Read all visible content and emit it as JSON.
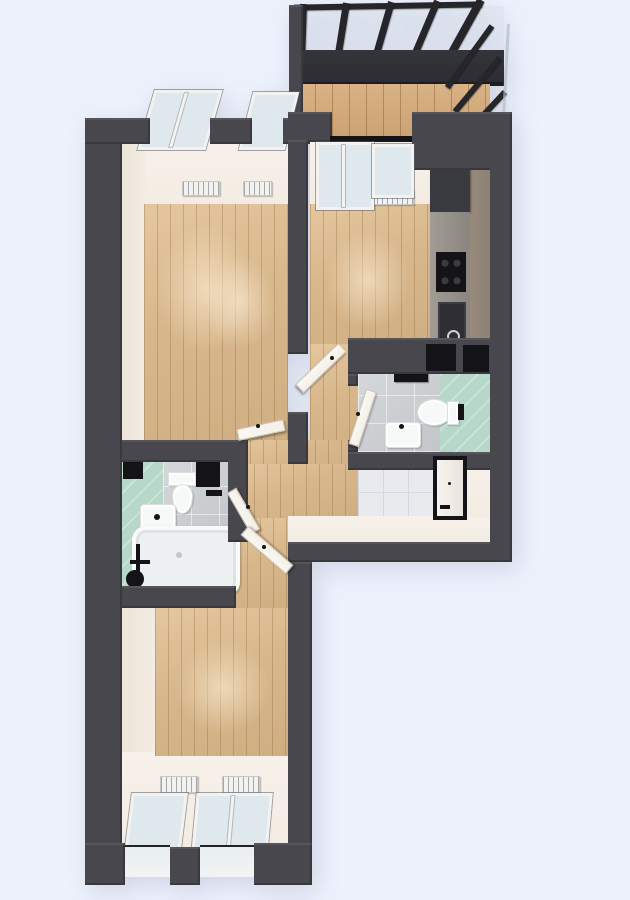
{
  "meta": {
    "kind": "3d-rendered-floor-plan",
    "view": "top-down",
    "visible_text": "none"
  },
  "palette": {
    "bg": "#edf1fc",
    "wall": "#47474d",
    "wallDark": "#222226",
    "beam": "#26262a",
    "railing": "#2c2c32",
    "wood": "#d8b78c",
    "woodLine": "rgba(146,106,56,0.35)",
    "balconyWood": "#cfa87a",
    "cream": "#f3ece3",
    "mint": "#b7d7c9",
    "mintLine": "rgba(255,255,255,0.28)",
    "grayTile": "#cbcfd2",
    "whiteTile": "#e9eaee",
    "tileLine": "#d6d8df",
    "fixture": "#f7f8f8",
    "fixtureEdge": "#d9dede",
    "glass": "#dfe8ec",
    "winFrame": "#f2f3f1",
    "door": "#f3efe8",
    "doorEdge": "#cfc7b8",
    "black": "#141418",
    "counter": "#96918a",
    "innerBrown": "#8d8072",
    "radiator": "#f2f2f0"
  },
  "rooms": [
    {
      "name": "balcony",
      "floor": "wood",
      "features": [
        "pergola-roof-beams",
        "glass-railing",
        "dark-railing-band"
      ]
    },
    {
      "name": "living-room",
      "floor": "wood",
      "features": [
        "window-double",
        "window-single",
        "radiator",
        "radiator",
        "open-door"
      ]
    },
    {
      "name": "kitchen",
      "floor": "wood",
      "features": [
        "balcony-door",
        "window",
        "radiator",
        "tall-cabinet",
        "counter",
        "cooktop",
        "sink",
        "open-door"
      ]
    },
    {
      "name": "bathroom-right",
      "floor": "gray-tile-and-mint-tile",
      "features": [
        "toilet",
        "washbasin",
        "towel-rail",
        "open-door"
      ]
    },
    {
      "name": "bathroom-left",
      "floor": "mint-tile-and-gray-tile",
      "features": [
        "bathtub",
        "shower-fixture",
        "washbasin",
        "toilet",
        "wall-niche",
        "wall-niche",
        "open-door"
      ]
    },
    {
      "name": "hallway",
      "floor": "wood"
    },
    {
      "name": "entry",
      "floor": "white-tile",
      "features": [
        "entrance-door"
      ]
    },
    {
      "name": "bedroom",
      "floor": "wood",
      "features": [
        "window-single",
        "window-double",
        "radiator",
        "radiator",
        "open-door"
      ]
    }
  ]
}
